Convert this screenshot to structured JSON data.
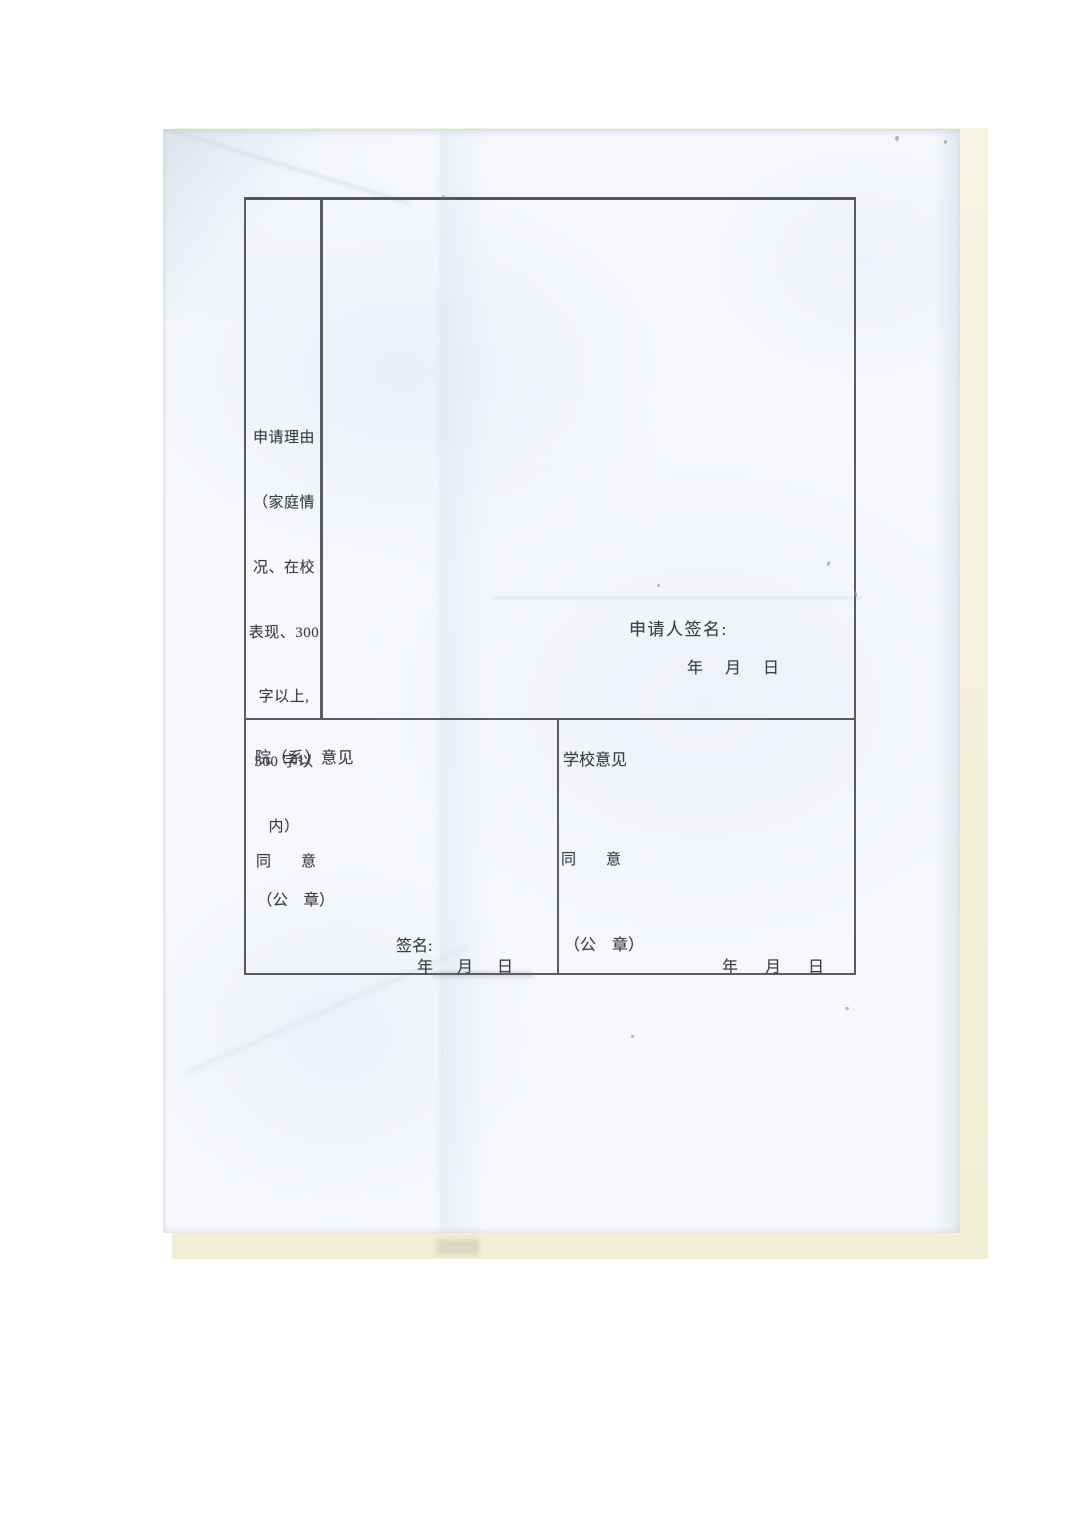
{
  "colors": {
    "background": "#ffffff",
    "paper": "#f6f8fc",
    "backing_sheet": "#f3f0da",
    "table_border": "#5b5c61",
    "text": "#3e4046"
  },
  "form": {
    "reason": {
      "full_text": "申请理由（家庭情况、在校表现、300字以上，500字以内）",
      "lines": [
        "申请理由",
        "（家庭情",
        "况、在校",
        "表现、300",
        "字以上,",
        "500 字以",
        "内）"
      ]
    },
    "applicant": {
      "signature_label": "申请人签名:",
      "date_line": "年　月　日"
    },
    "department_opinion": {
      "title": "院（系）意见",
      "agree": "同　　意",
      "seal": "（公　章）",
      "signature_label": "签名:",
      "date_line": "年　月　日"
    },
    "school_opinion": {
      "title": "学校意见",
      "agree": "同　　意",
      "seal": "（公　章）",
      "date_line": "年　月　日"
    }
  }
}
